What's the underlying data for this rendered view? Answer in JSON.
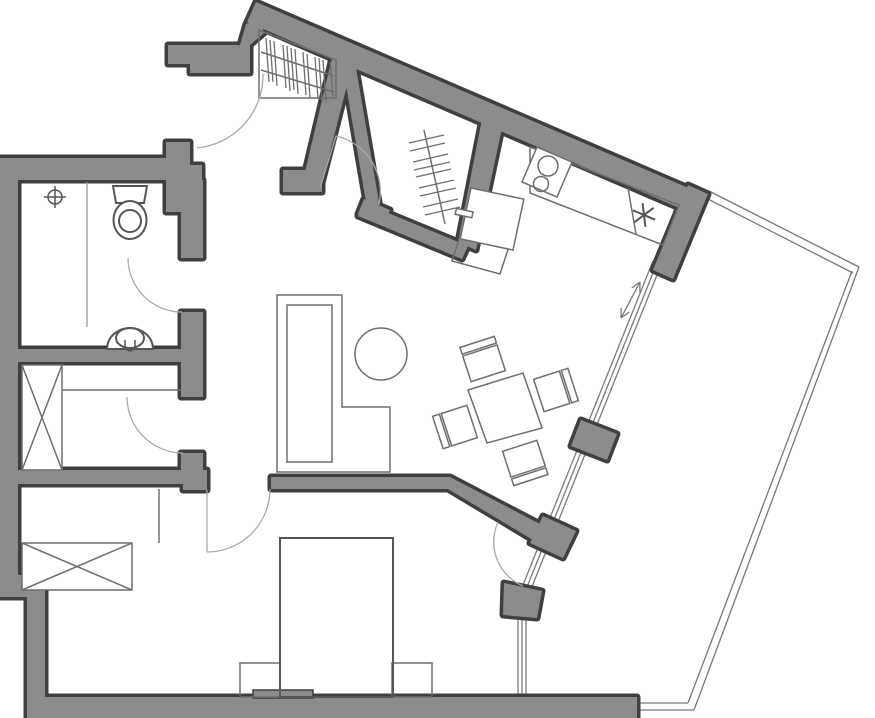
{
  "canvas": {
    "width": 875,
    "height": 718,
    "background": "#ffffff"
  },
  "palette": {
    "paper": "#ffffff",
    "wall_fill": "#8c8c8c",
    "wall_outline": "#3f3f3f",
    "furniture_line": "#6e6e6e",
    "fixture_line": "#565656",
    "door_arc": "#a9a9a9",
    "glass_line": "#7a7a7a",
    "balcony_line": "#777777",
    "partition_line": "#9a9a9a"
  },
  "plan": {
    "door_arcs": 6,
    "sliding_door_arrow": "double-headed",
    "fixtures": [
      "entry-door",
      "coat-rack-rail",
      "walk-in-wardrobe-rail",
      "hallway",
      "kitchen-counter-l",
      "stove-two-burner",
      "kitchen-sink",
      "asterisk-symbol",
      "sliding-glass-wall",
      "balcony",
      "toilet",
      "washbasin",
      "shower-drain",
      "shower-partition",
      "storage-cabinet-x",
      "storage-shelf",
      "bedroom-wardrobe-x",
      "closet-line",
      "double-bed",
      "nightstand",
      "nightstand",
      "desk-l-shaped",
      "desk-chair",
      "dining-table",
      "dining-chair",
      "dining-chair",
      "dining-chair",
      "dining-chair",
      "radiator-nub"
    ]
  }
}
